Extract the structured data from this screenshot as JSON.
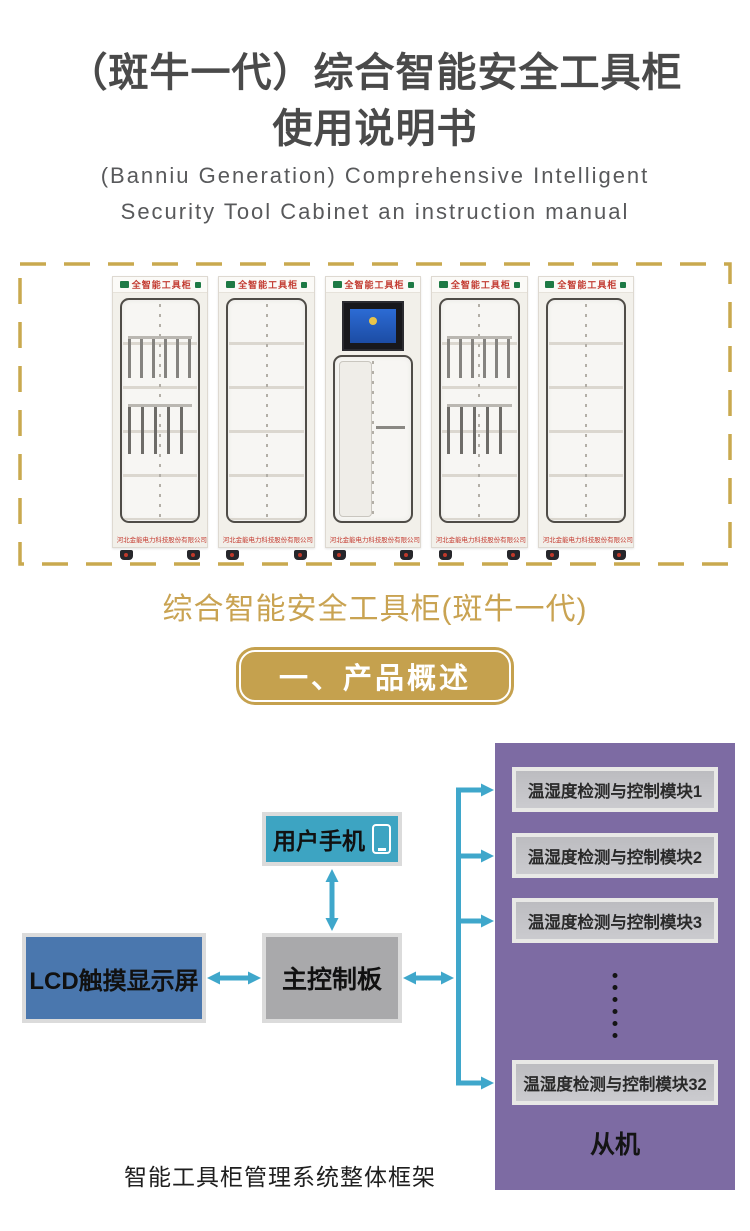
{
  "header": {
    "title_line1": "（斑牛一代）综合智能安全工具柜",
    "title_line2": "使用说明书",
    "subtitle_line1": "(Banniu Generation) Comprehensive Intelligent",
    "subtitle_line2": "Security Tool Cabinet an instruction manual"
  },
  "photo": {
    "cabinet_header": "全智能工具柜",
    "company_label": "河北金能电力科技股份有限公司",
    "caption": "综合智能安全工具柜(斑牛一代)"
  },
  "section": {
    "banner_label": "一、产品概述"
  },
  "diagram": {
    "phone_label": "用户手机",
    "lcd_label": "LCD触摸显示屏",
    "controller_label": "主控制板",
    "modules": [
      "温湿度检测与控制模块1",
      "温湿度检测与控制模块2",
      "温湿度检测与控制模块3",
      "温湿度检测与控制模块32"
    ],
    "slave_label": "从机",
    "caption": "智能工具柜管理系统整体框架"
  },
  "colors": {
    "accent_gold": "#c5a14e",
    "caption_gold": "#c9a352",
    "arrow_cyan": "#3fa7cb",
    "panel_purple": "#7d6ba3",
    "phone_teal": "#3da4c2",
    "lcd_blue": "#4a77ae",
    "controller_gray": "#a9a9ab",
    "cabinet_red": "#c23a30",
    "title_gray": "#4a4a4a"
  }
}
